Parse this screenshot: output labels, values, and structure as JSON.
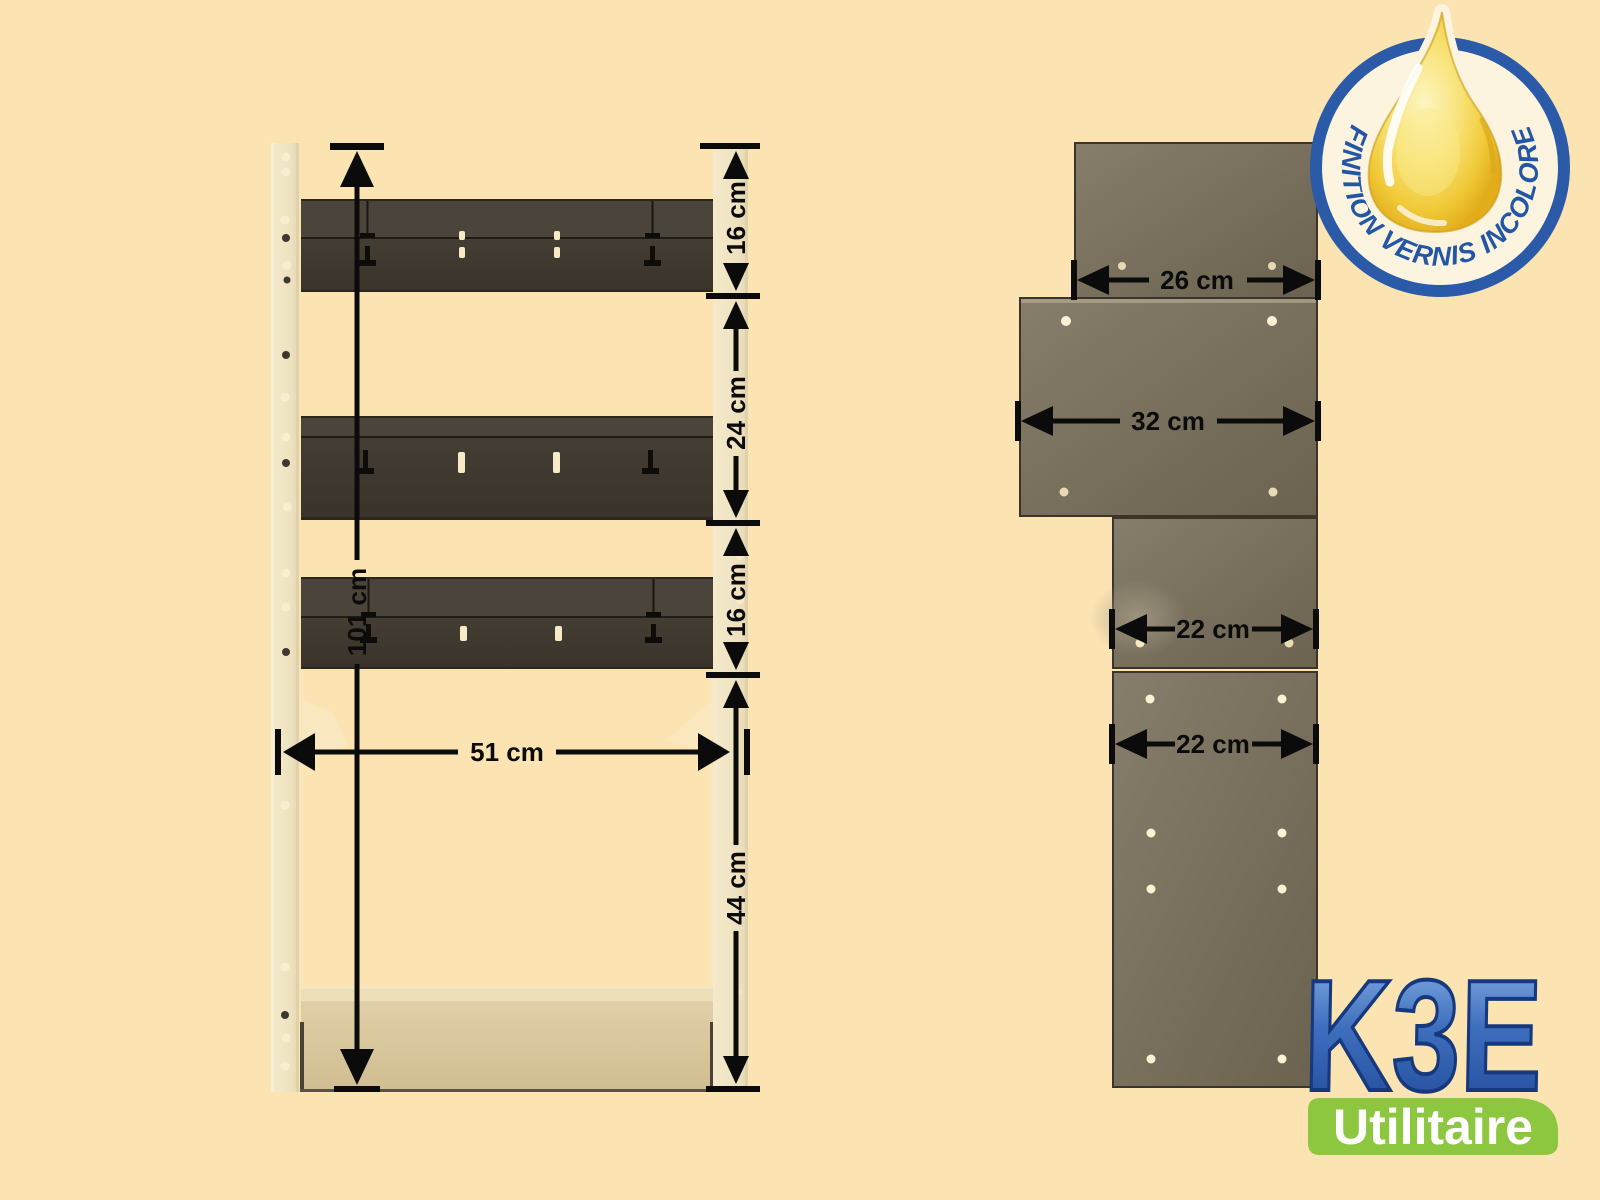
{
  "front_view": {
    "height_dim": "101 cm",
    "width_dim": "51 cm",
    "side_dims": [
      "16 cm",
      "24 cm",
      "16 cm",
      "44 cm"
    ]
  },
  "side_view": {
    "panel_dims": [
      "26 cm",
      "32 cm",
      "22 cm",
      "22 cm"
    ]
  },
  "badge": {
    "label": "FINITION VERNIS INCOLORE"
  },
  "logo": {
    "brand": "K3E",
    "tagline": "Utilitaire"
  },
  "colors": {
    "background": "#FBE3B2",
    "badge_blue": "#2B5AA8",
    "drop_yellow": "#F2CE3C",
    "logo_blue": "#2C5DAD",
    "banner_green": "#8DC63F",
    "shelf_dark": "#3E382F",
    "panel_olive": "#776E5C",
    "upright_cream": "#F0E5C6",
    "dimension_black": "#0B0B0B"
  }
}
